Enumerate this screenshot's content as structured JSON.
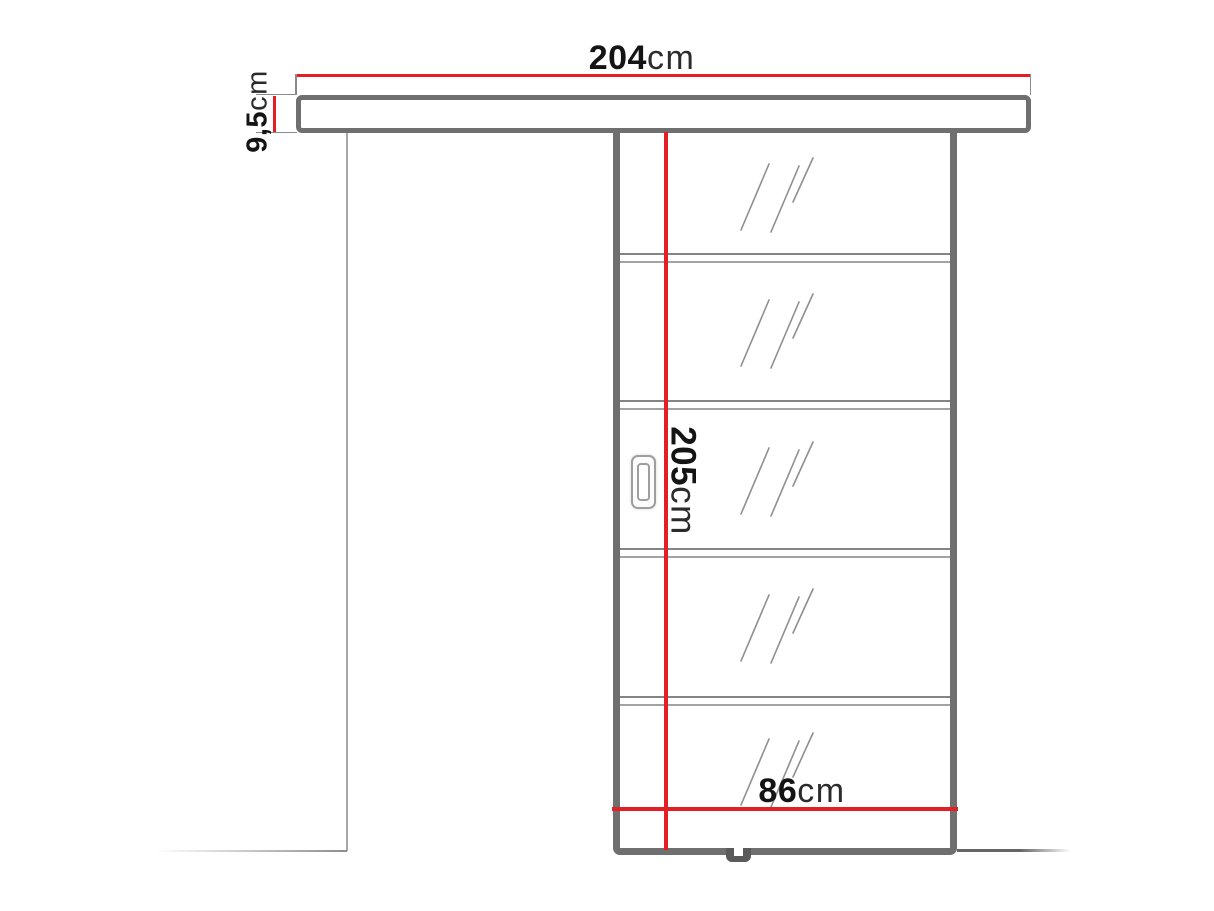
{
  "diagram": {
    "type": "sliding-door-dimension-drawing",
    "dimensions": {
      "rail_width": {
        "value": "204",
        "unit": "cm"
      },
      "rail_height": {
        "value": "9,5",
        "unit": "cm"
      },
      "door_height": {
        "value": "205",
        "unit": "cm"
      },
      "door_width": {
        "value": "86",
        "unit": "cm"
      }
    },
    "panel": {
      "sections": 5,
      "glass_mark": "glass-hatch"
    },
    "colors": {
      "dimension_line": "#e31e24",
      "outline": "#6f6f6f",
      "thin_line": "#9b9b9b",
      "text": "#141414"
    }
  }
}
